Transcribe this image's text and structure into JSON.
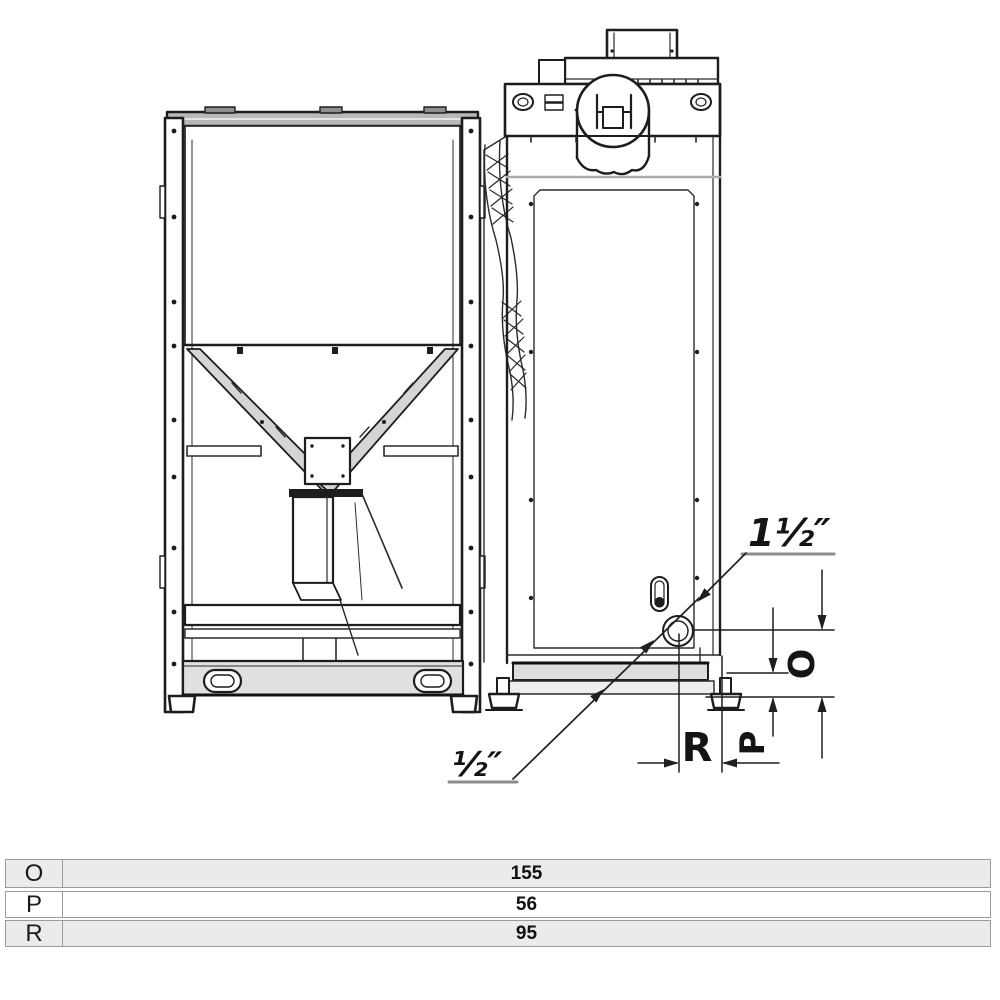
{
  "page": {
    "background": "#ffffff"
  },
  "drawing": {
    "title": "pellet-boiler-with-hopper-dimension-drawing",
    "annotations": {
      "pipe_size_large": "1½″",
      "pipe_size_small": "½″",
      "dim_letter_o": "O",
      "dim_letter_p": "P",
      "dim_letter_r": "R"
    },
    "colors": {
      "line": "#2b2b2b",
      "dim_line": "#1f1f1f",
      "shade_light": "#e3e3e3",
      "shade_mid": "#c9c9c9",
      "underline_gray": "#8c8c8c"
    }
  },
  "table": {
    "rows": [
      {
        "label": "O",
        "value": "155"
      },
      {
        "label": "P",
        "value": "56"
      },
      {
        "label": "R",
        "value": "95"
      }
    ]
  }
}
